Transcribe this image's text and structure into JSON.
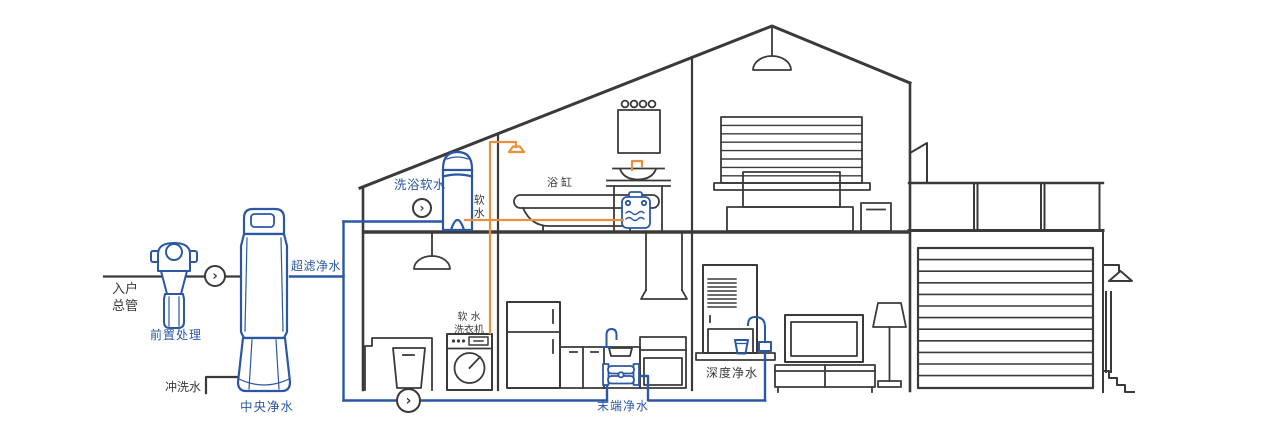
{
  "diagram": {
    "colors": {
      "line": "#3b3a38",
      "blue": "#2b57a5",
      "orange": "#e8913c",
      "background": "#ffffff"
    },
    "flow_arrow": "›",
    "labels": {
      "inlet_line1": "入户",
      "inlet_line2": "总管",
      "pre_treatment": "前置处理",
      "flush_water": "冲洗水",
      "central_purification": "中央净水",
      "ultrafiltration": "超滤净水",
      "bath_softening": "洗浴软水",
      "soft_water": "软水",
      "bathtub": "浴缸",
      "soft_water_washer_line1": "软 水",
      "soft_water_washer_line2": "洗衣机",
      "terminal_purification": "末端净水",
      "deep_purification": "深度净水"
    }
  }
}
